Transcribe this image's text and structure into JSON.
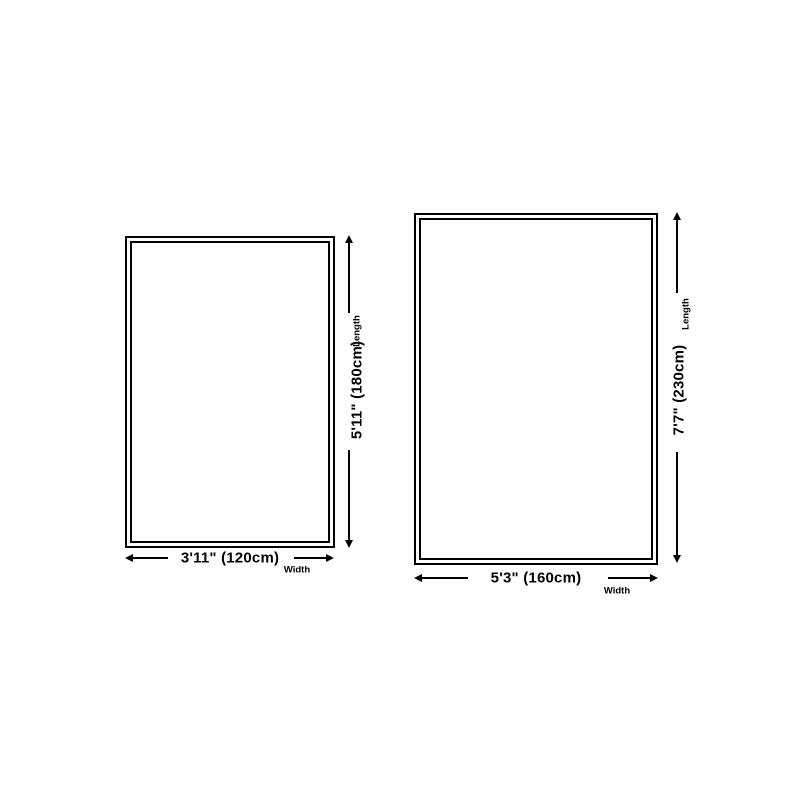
{
  "canvas": {
    "background": "#ffffff",
    "line_color": "#000000"
  },
  "diagrams": [
    {
      "id": "rug-small",
      "length_value": "5'11\" (180cm)",
      "length_axis": "Length",
      "width_value": "3'11\" (120cm)",
      "width_axis": "Width"
    },
    {
      "id": "rug-large",
      "length_value": "7'7\" (230cm)",
      "length_axis": "Length",
      "width_value": "5'3\" (160cm)",
      "width_axis": "Width"
    }
  ]
}
